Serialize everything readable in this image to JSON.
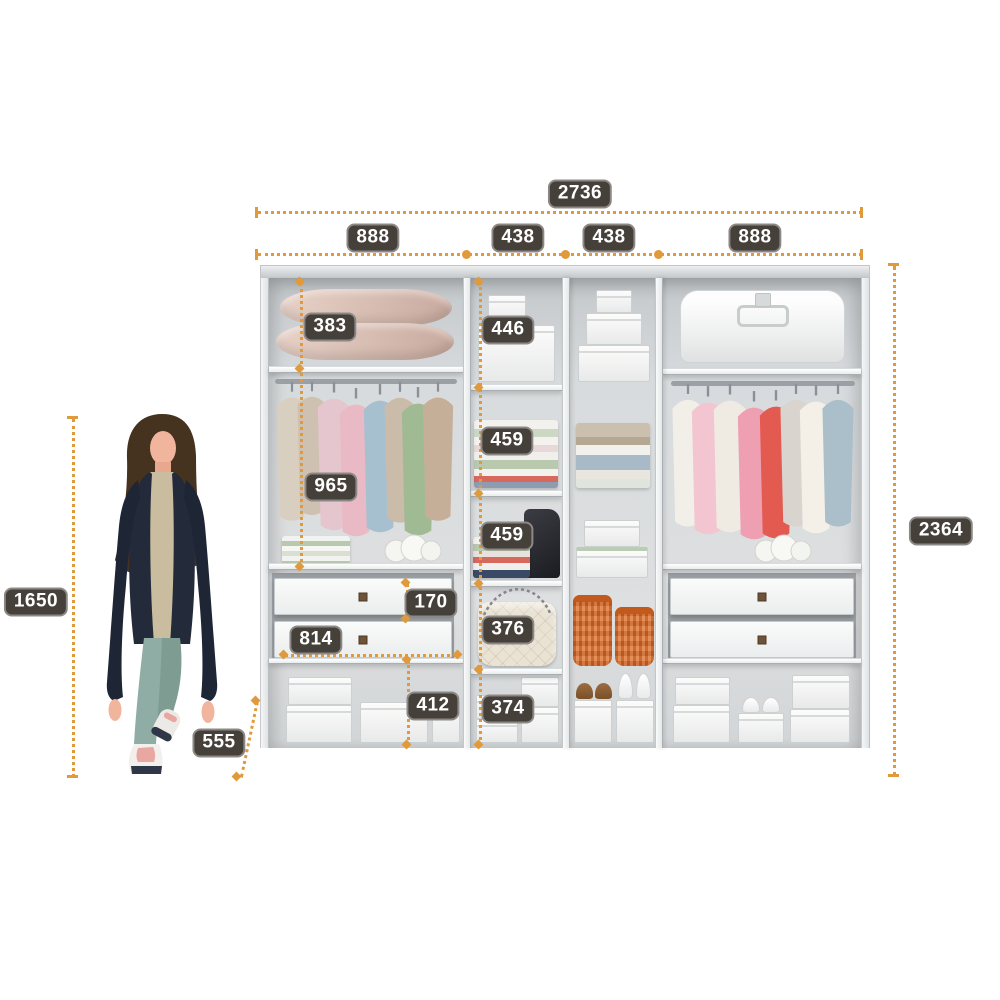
{
  "diagram": {
    "subject": "wardrobe-interior-dimensions",
    "colors": {
      "dimension_accent": "#E0993B",
      "label_background": "#46403A",
      "label_text": "#FFFFFF",
      "floor_strip": "#3A2B1F",
      "basket_orange": "#E0702C"
    }
  },
  "dimensions": {
    "total_width": "2736",
    "total_height": "2364",
    "depth": "555",
    "person_height": "1650",
    "sections": {
      "s1": "888",
      "s2": "438",
      "s3": "438",
      "s4": "888"
    },
    "left_top_shelf": "383",
    "left_hanging": "965",
    "drawer_height": "170",
    "drawer_width": "814",
    "left_bottom": "412",
    "mid_top_shelf": "446",
    "mid_shelf2": "459",
    "mid_shelf3": "459",
    "mid_shelf4": "376",
    "mid_bottom": "374"
  }
}
